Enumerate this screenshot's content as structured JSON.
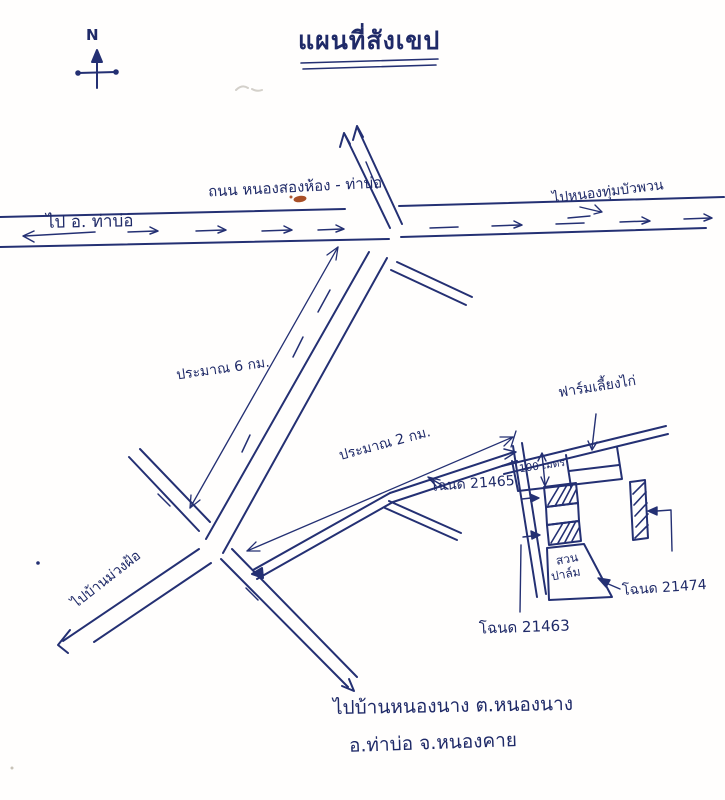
{
  "meta": {
    "kind": "hand-drawn sketch map (scanned, blue ballpoint ink)",
    "language": "Thai"
  },
  "colors": {
    "ink": "#243073",
    "paper": "#fffefd",
    "correction_red": "#9e3c0f",
    "pencil_gray": "#b7b2a9"
  },
  "title": {
    "text": "แผนที่สังเขป"
  },
  "compass": {
    "label": "N"
  },
  "labels": {
    "road_name": "ถนน หนองสองห้อง - ท่าบ่อ",
    "to_left": "ไป อ. ท่าบ่อ",
    "to_right": "ไปหนองทุ่มบัวพวน",
    "approx_6km": "ประมาณ 6 กม.",
    "approx_2km": "ประมาณ 2 กม.",
    "to_southwest": "ไปบ้านม่วงฝ้อ",
    "chicken_farm": "ฟาร์มเลี้ยงไก่",
    "hundred_m": "100 เมตร",
    "palm_line1": "สวน",
    "palm_line2": "ปาล์ม",
    "deed_21465": "โฉนด 21465",
    "deed_21463": "โฉนด 21463",
    "deed_21474": "โฉนด 21474",
    "destination_line1": "ไปบ้านหนองนาง ต.หนองนาง",
    "destination_line2": "อ.ท่าบ่อ จ.หนองคาย"
  }
}
